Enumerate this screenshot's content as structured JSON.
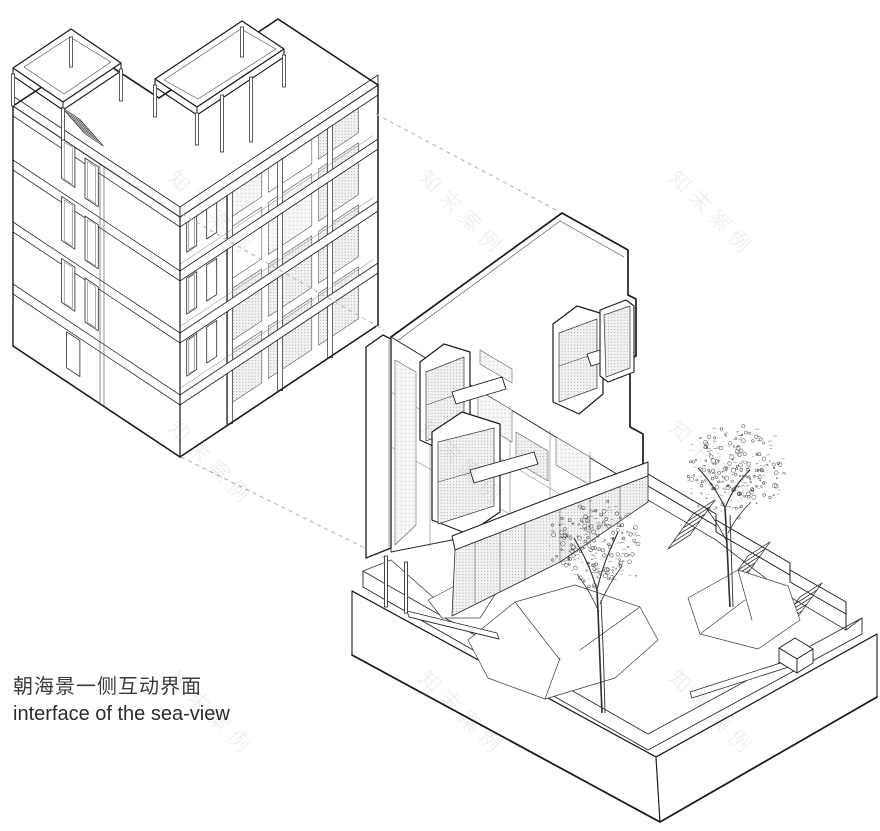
{
  "caption": {
    "zh": "朝海景一侧互动界面",
    "en": "interface of the sea-view"
  },
  "watermark": {
    "text": "知末案例",
    "font_size": 21,
    "letter_spacing": 7,
    "rotation_deg": 45,
    "opacity": 0.06,
    "grid_centers": [
      [
        212,
        213
      ],
      [
        463,
        213
      ],
      [
        713,
        213
      ],
      [
        212,
        463
      ],
      [
        463,
        463
      ],
      [
        713,
        463
      ],
      [
        212,
        713
      ],
      [
        463,
        713
      ],
      [
        713,
        713
      ]
    ]
  },
  "colors": {
    "background": "#ffffff",
    "ink": "#1c1c1c",
    "ink_medium": "#3a3a3a",
    "ink_light": "#6a6a6a",
    "hatch_fill": "#f2f2f2",
    "hatch_dot": "#8f8f8f",
    "dash_line": "#b5b5b5",
    "foliage": "#2e2e2e"
  },
  "trees": [
    {
      "name": "tree-left",
      "cx": 597,
      "cy": 546,
      "rx": 51,
      "ry": 49,
      "dots": 230,
      "seed": 7
    },
    {
      "name": "tree-right",
      "cx": 733,
      "cy": 471,
      "rx": 57,
      "ry": 47,
      "dots": 250,
      "seed": 13
    }
  ]
}
